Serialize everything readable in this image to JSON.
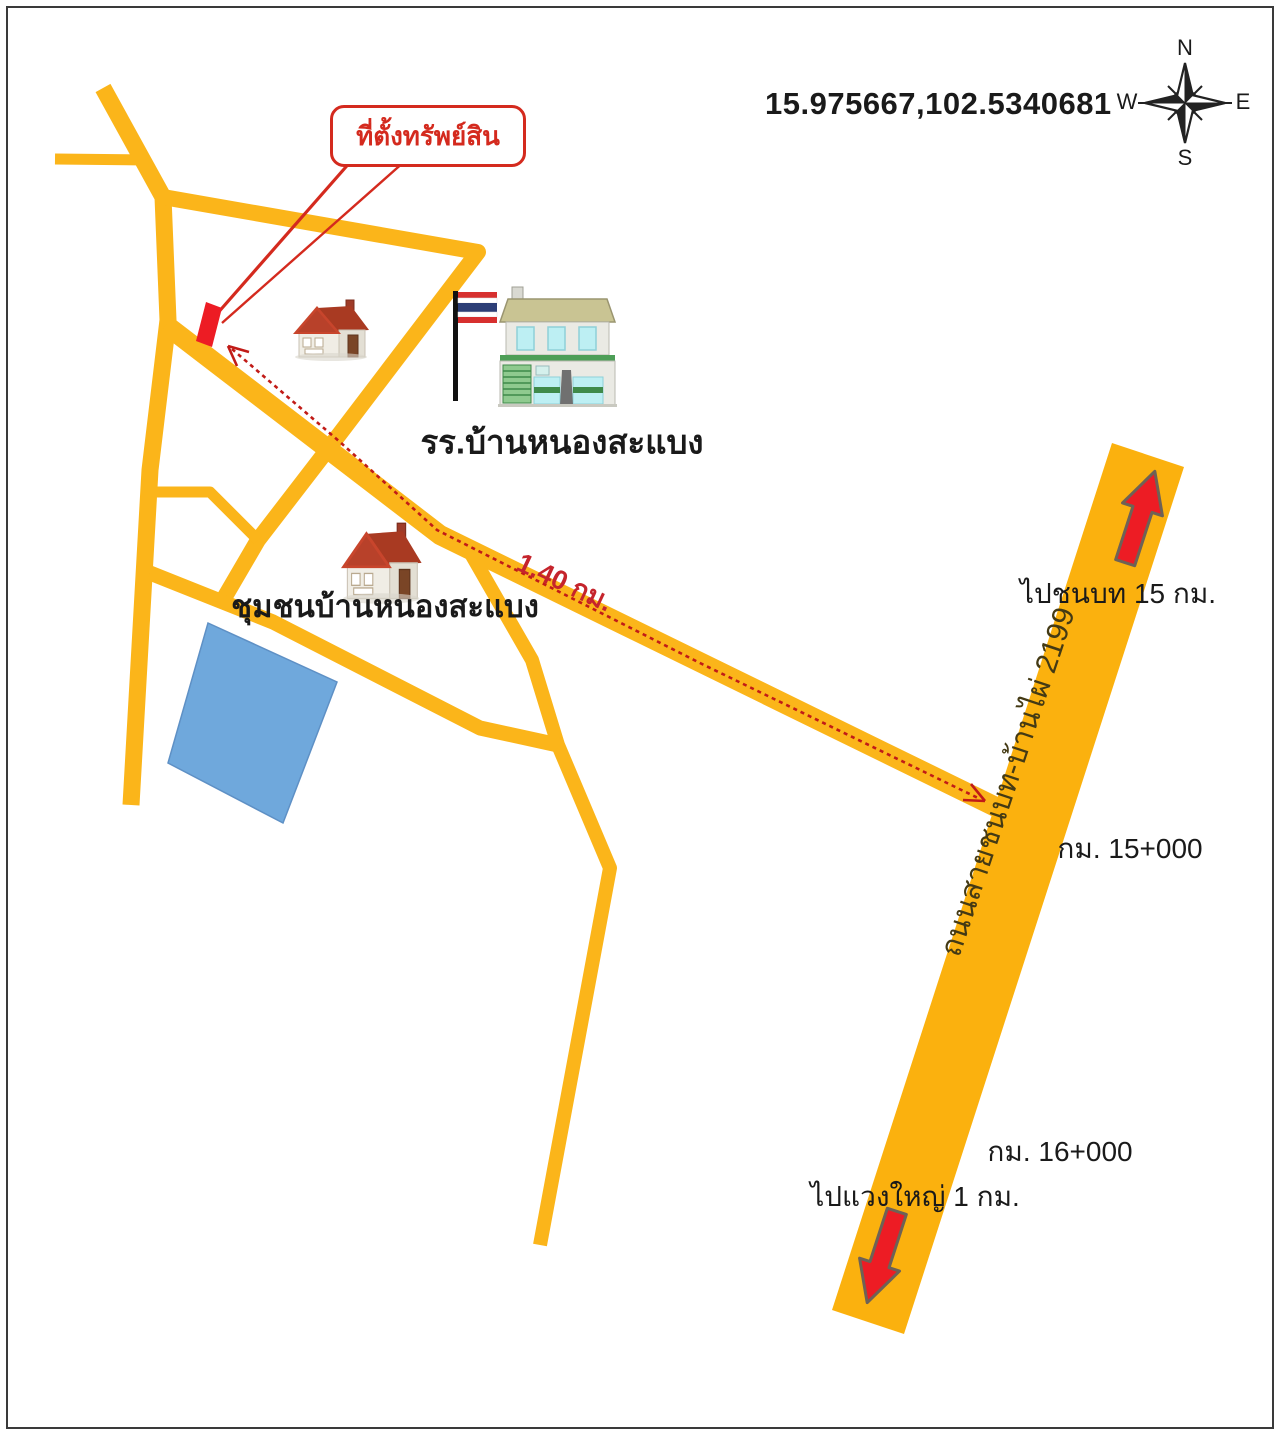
{
  "map": {
    "coordinates_label": "15.975667,102.5340681",
    "compass": {
      "north": "N",
      "south": "S",
      "east": "E",
      "west": "W"
    },
    "callout": {
      "text": "ที่ตั้งทรัพย์สิน"
    },
    "landmarks": {
      "school_label": "รร.บ้านหนองสะแบง",
      "community_label": "ชุมชนบ้านหนองสะแบง"
    },
    "route": {
      "distance_label": "1.40 กม."
    },
    "highway": {
      "name_label": "ถนนสายชนบท-บ้านไผ่ 2199",
      "north_destination_label": "ไปชนบท 15 กม.",
      "south_destination_label": "ไปแวงใหญ่ 1 กม.",
      "km_marker_15": "กม. 15+000",
      "km_marker_16": "กม. 16+000"
    },
    "colors": {
      "road": "#FBB51A",
      "highway": "#FBB10E",
      "pond": "#6FA8DC",
      "pond_border": "#5E90C5",
      "route_red": "#C11B17",
      "callout_red": "#D42A1E",
      "arrow_red": "#ED1C24",
      "arrow_outline": "#6E6256",
      "text": "#1A1A1A"
    }
  }
}
